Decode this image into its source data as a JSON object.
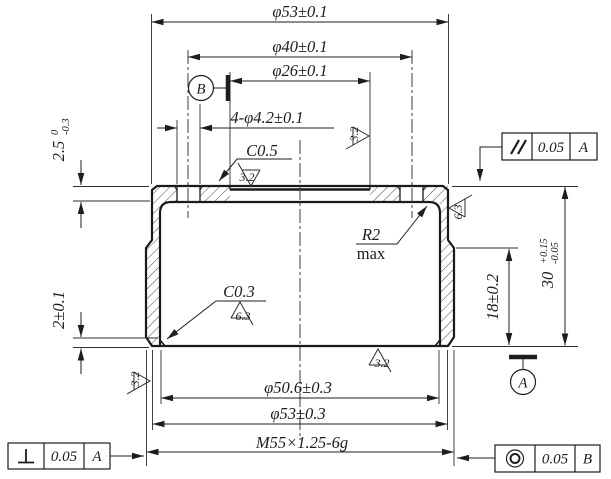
{
  "drawing": {
    "dimensions": {
      "outer_diameter_top": "φ53±0.1",
      "bolt_circle_diameter": "φ40±0.1",
      "recess_diameter": "φ26±0.1",
      "hole_pattern": "4-φ4.2±0.1",
      "top_chamfer": "C0.5",
      "inner_chamfer": "C0.3",
      "inner_radius": "R2",
      "inner_radius_qualifier": "max",
      "top_wall_thickness": "2.5",
      "top_wall_upper_tol": "0",
      "top_wall_lower_tol": "-0.3",
      "lip_thickness": "2±0.1",
      "thread_depth": "18±0.2",
      "overall_height": "30",
      "overall_height_upper_tol": "+0.15",
      "overall_height_lower_tol": "-0.05",
      "bore_diameter": "φ50.6±0.3",
      "outer_diameter_bottom": "φ53±0.3",
      "thread_spec": "M55×1.25-6g"
    },
    "surface_finish": {
      "fine": "3.2",
      "medium": "6.3"
    },
    "feature_controls": {
      "parallelism": {
        "tolerance": "0.05",
        "datum": "A"
      },
      "perpendicularity": {
        "tolerance": "0.05",
        "datum": "A"
      },
      "concentricity": {
        "tolerance": "0.05",
        "datum": "B"
      }
    },
    "datums": {
      "a": "A",
      "b": "B"
    }
  }
}
